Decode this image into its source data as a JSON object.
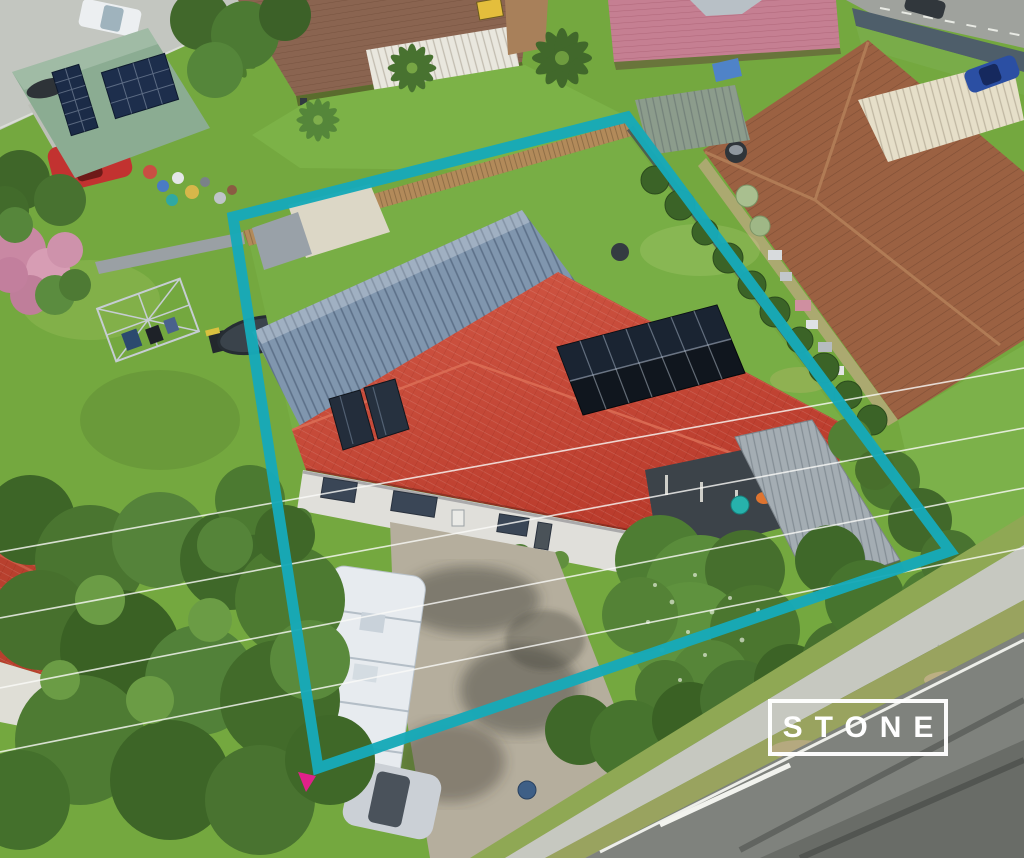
{
  "watermark": {
    "label": "STONE"
  },
  "scene": {
    "description": "Aerial drone photograph of a suburban property outlined with a teal lot boundary, red-tiled house with rooftop solar panels, blue metal shed roof, driveway with caravan, surrounded by neighbouring houses, lawns, trees and a street at lower right",
    "boundary": {
      "color": "#17A9B8",
      "marker_color": "#E0218A",
      "stroke_width": 11,
      "corners": [
        [
          233,
          217
        ],
        [
          627,
          117
        ],
        [
          950,
          551
        ],
        [
          318,
          768
        ]
      ]
    },
    "colors": {
      "teal": "#17A9B8",
      "lawn": "#74A83F",
      "lawn_light": "#8CBD51",
      "lawn_shadow": "#55832E",
      "tree_dark": "#3E6628",
      "tree_mid": "#5C8A33",
      "tree_light": "#7FAE4C",
      "red_roof": "#C64533",
      "red_roof_light": "#D4604B",
      "shed_roof": "#8096AE",
      "brown_roof": "#9B6142",
      "pink_roof": "#C57F92",
      "green_roof": "#8BAC92",
      "brown_roof_2": "#8A6450",
      "solar": "#10161E",
      "fence_timber": "#B28A5A",
      "concrete": "#C3C6C0",
      "driveway": "#B5AE9D",
      "road": "#7F827D",
      "footpath": "#C6C8C0",
      "walls": "#E0DFDA",
      "caravan": "#E7EBEF"
    },
    "objects": [
      "subject-house-red-roof",
      "solar-panel-array",
      "solar-hot-water-panels",
      "metal-shed-roof",
      "carport",
      "backyard-lawn",
      "timber-back-fence",
      "driveway",
      "caravan",
      "parked-car",
      "front-garden-trees",
      "neighbour-house-left",
      "neighbour-house-top-left-solar",
      "neighbour-house-top-middle",
      "neighbour-house-pink-roof",
      "neighbour-house-right-brown-roof",
      "rotary-clothesline",
      "trampoline",
      "street-road",
      "footpath",
      "power-lines",
      "property-boundary-outline",
      "stone-watermark"
    ]
  }
}
